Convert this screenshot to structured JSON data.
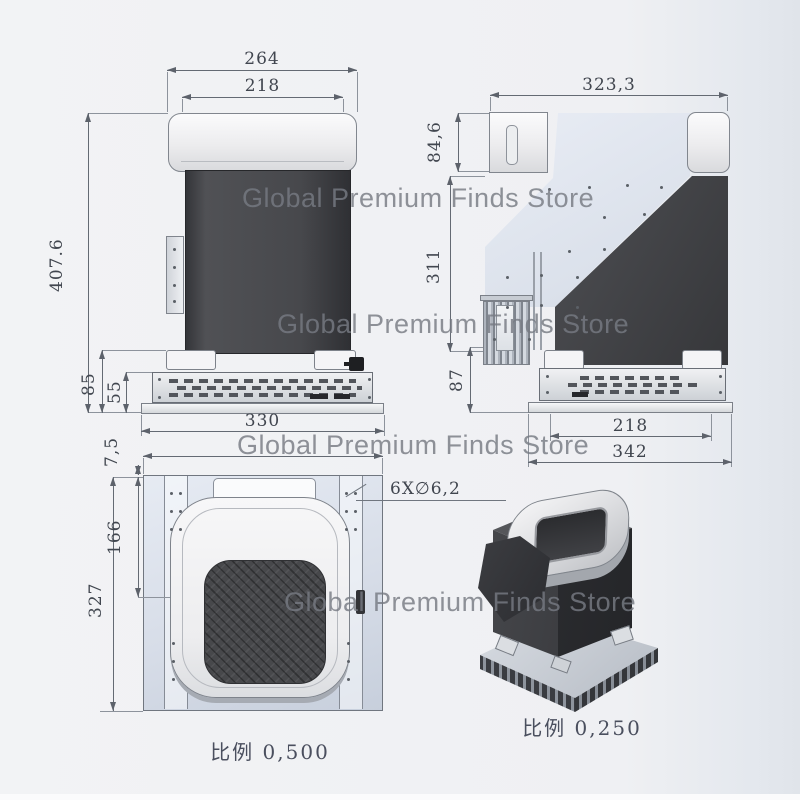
{
  "watermark_text": "Global Premium Finds Store",
  "colors": {
    "background": "#eff0f3",
    "dimension_line": "#646a73",
    "dark_body": "#47484b",
    "light_housing": "#ececee",
    "blue_plate": "#dbe1eb",
    "watermark": "#787c82"
  },
  "front_view": {
    "dim_overall_width": "264",
    "dim_cap_width": "218",
    "dim_overall_height": "407.6",
    "dim_foot_height": "85",
    "dim_panel_height": "55",
    "dim_base_width": "330"
  },
  "side_view": {
    "dim_overall_depth": "323,3",
    "dim_top_section_height": "84,6",
    "dim_body_height": "311",
    "dim_lower_height": "87",
    "dim_panel_depth": "218",
    "dim_base_depth": "342"
  },
  "bottom_view": {
    "dim_edge_offset": "7,5",
    "dim_panel_offset": "166",
    "dim_plate_height": "327",
    "hole_callout": "6X∅6,2",
    "scale_label": "比例 0,500"
  },
  "iso_view": {
    "scale_label": "比例 0,250"
  }
}
